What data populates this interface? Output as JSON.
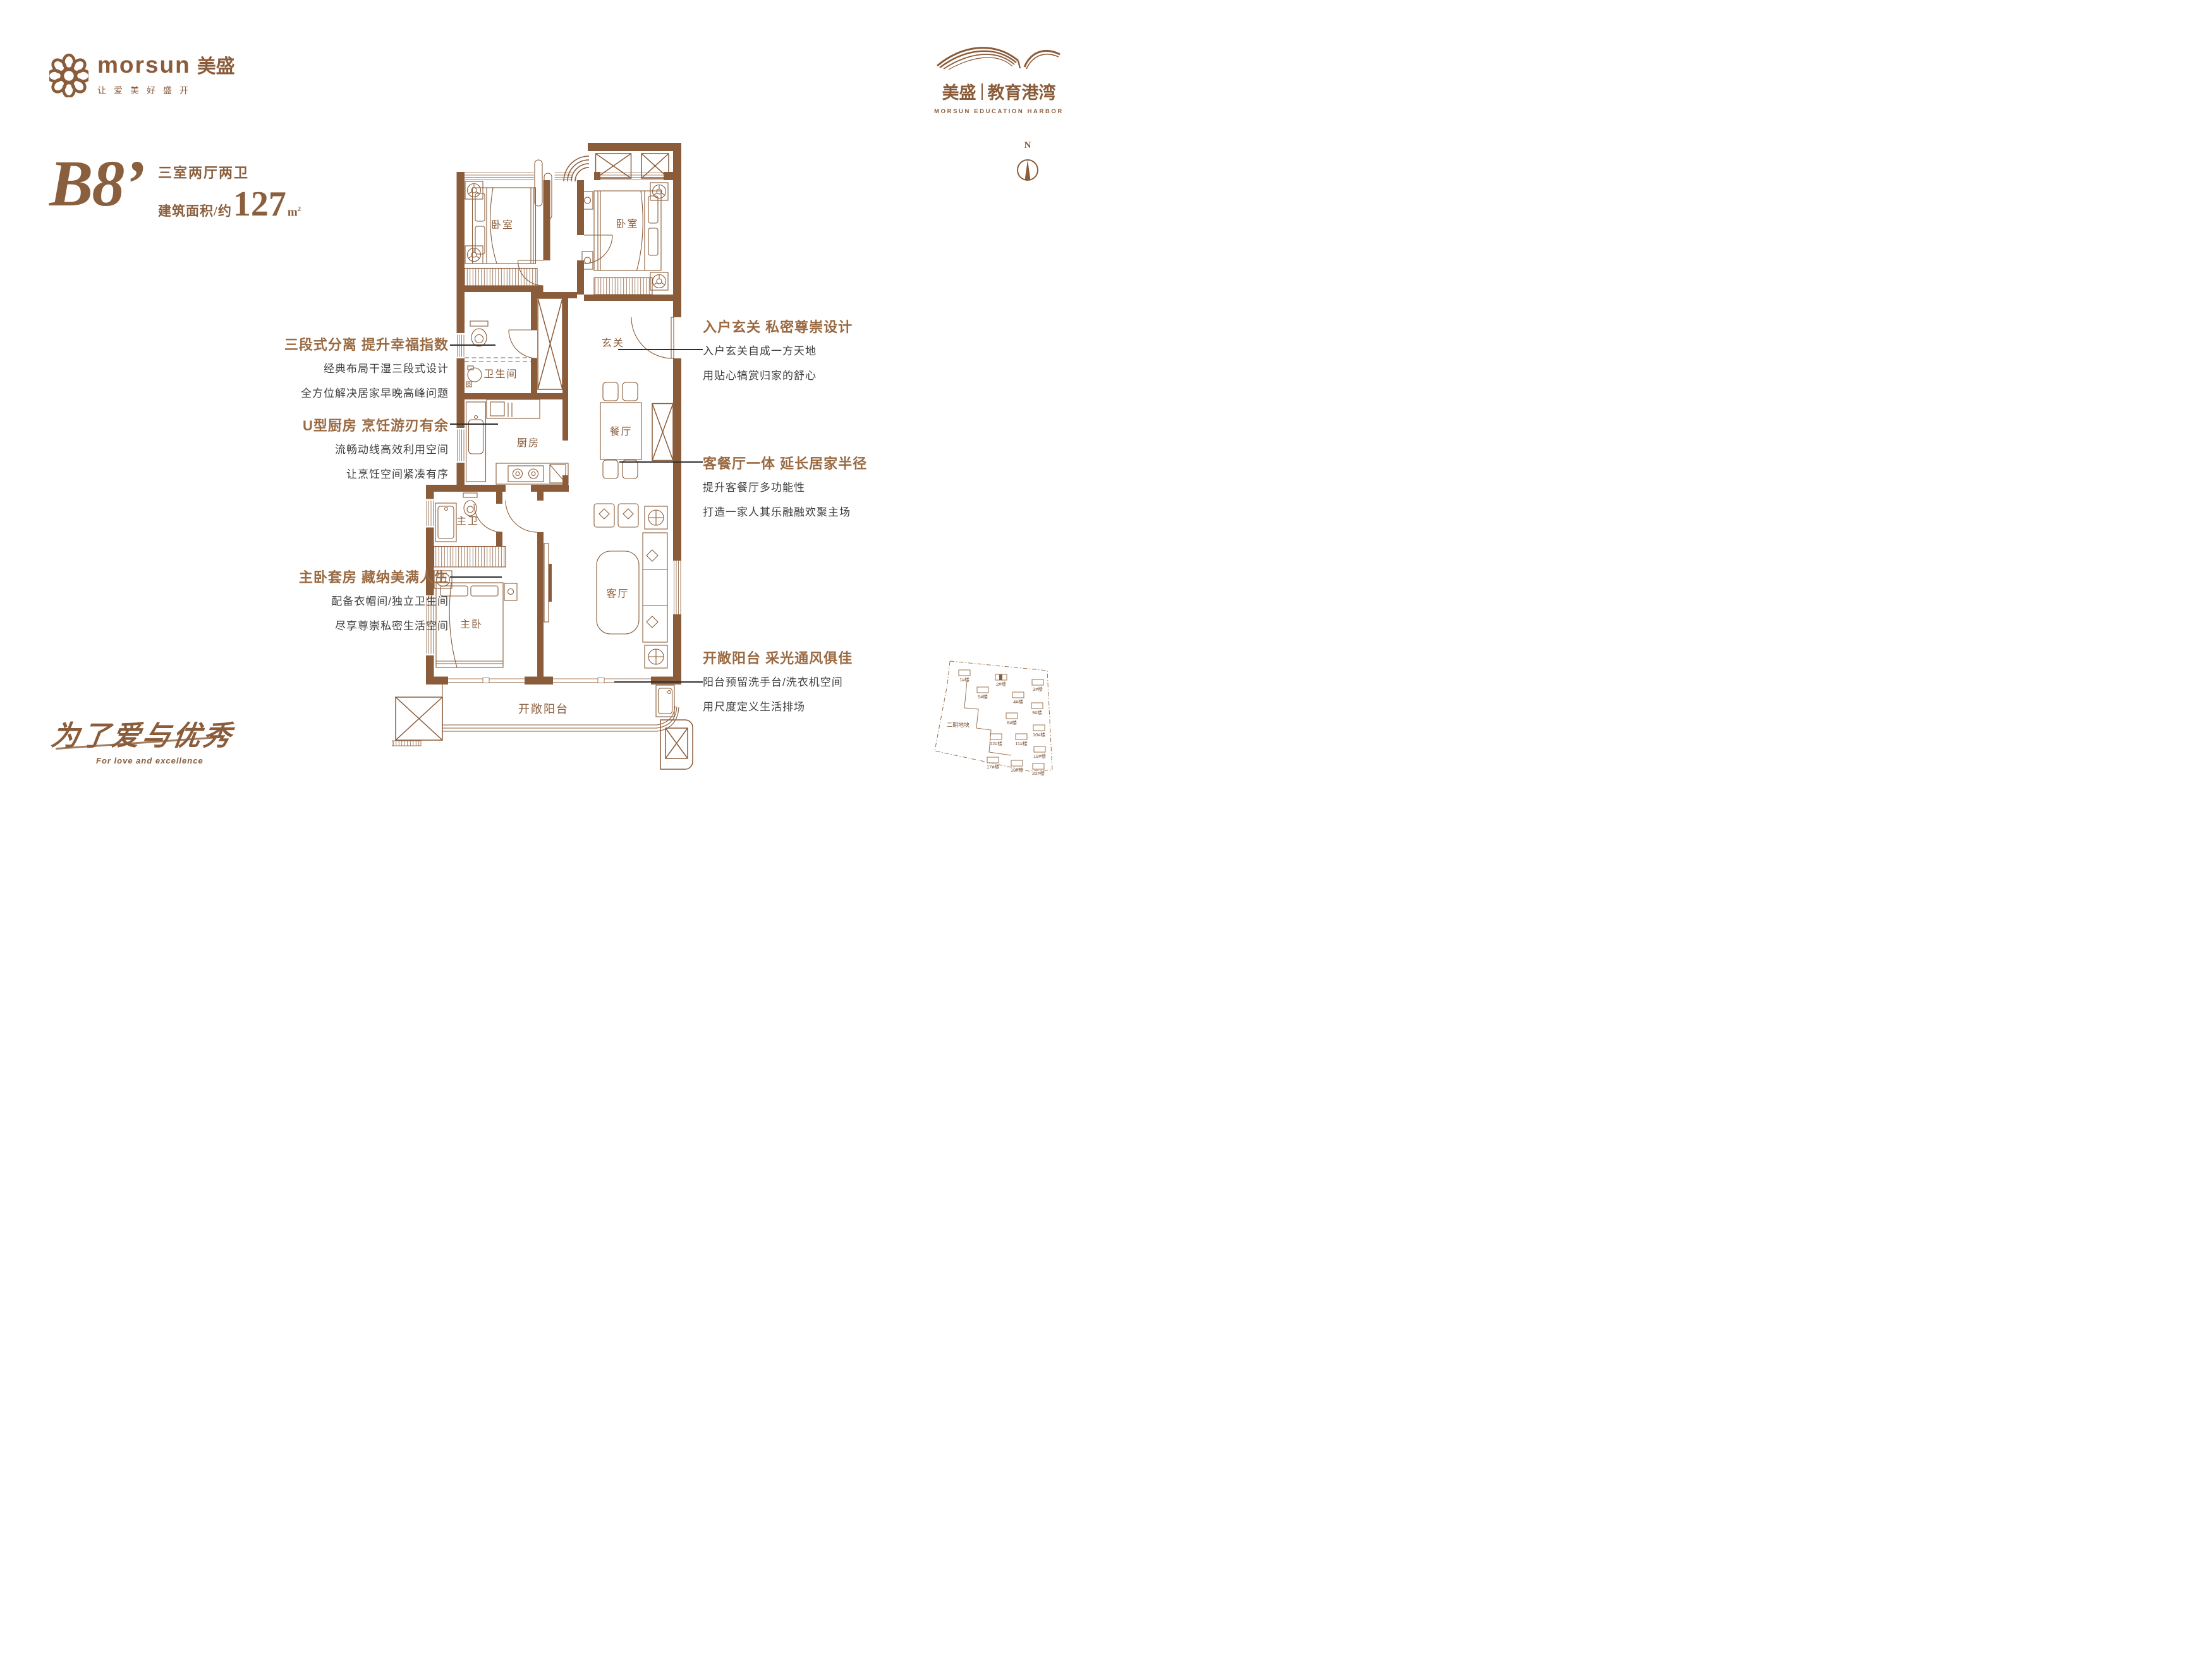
{
  "brand": {
    "logo_text": "morsun",
    "logo_cn": "美盛",
    "tagline": "让爱美好盛开"
  },
  "project": {
    "logo_left": "美盛",
    "logo_right": "教育港湾",
    "logo_en": "MORSUN EDUCATION HARBOR"
  },
  "unit": {
    "code": "B8’",
    "layout": "三室两厅两卫",
    "area_prefix": "建筑面积/约",
    "area_value": "127",
    "area_unit": "m",
    "area_sup": "2"
  },
  "compass": {
    "north_label": "N"
  },
  "floor_plan": {
    "rooms": [
      "卧室",
      "卧室",
      "卫生间",
      "厨房",
      "玄关",
      "餐厅",
      "主卫",
      "主卧",
      "客厅",
      "开敞阳台"
    ]
  },
  "annotations_left": [
    {
      "title": "三段式分离 提升幸福指数",
      "line1": "经典布局干湿三段式设计",
      "line2": "全方位解决居家早晚高峰问题"
    },
    {
      "title": "U型厨房 烹饪游刃有余",
      "line1": "流畅动线高效利用空间",
      "line2": "让烹饪空间紧凑有序"
    },
    {
      "title": "主卧套房 藏纳美满人生",
      "line1": "配备衣帽间/独立卫生间",
      "line2": "尽享尊崇私密生活空间"
    }
  ],
  "annotations_right": [
    {
      "title": "入户玄关 私密尊崇设计",
      "line1": "入户玄关自成一方天地",
      "line2": "用贴心犒赏归家的舒心"
    },
    {
      "title": "客餐厅一体 延长居家半径",
      "line1": "提升客餐厅多功能性",
      "line2": "打造一家人其乐融融欢聚主场"
    },
    {
      "title": "开敞阳台 采光通风俱佳",
      "line1": "阳台预留洗手台/洗衣机空间",
      "line2": "用尺度定义生活排场"
    }
  ],
  "slogan": {
    "cn": "为了爱与优秀",
    "en": "For love and excellence"
  },
  "site_map": {
    "phase_label": "二期地块",
    "buildings": [
      "1#楼",
      "2#楼",
      "3#楼",
      "5#楼",
      "4#楼",
      "9#楼",
      "8#楼",
      "10#楼",
      "12#楼",
      "11#楼",
      "19#楼",
      "17#楼",
      "18#楼",
      "20#楼"
    ]
  }
}
